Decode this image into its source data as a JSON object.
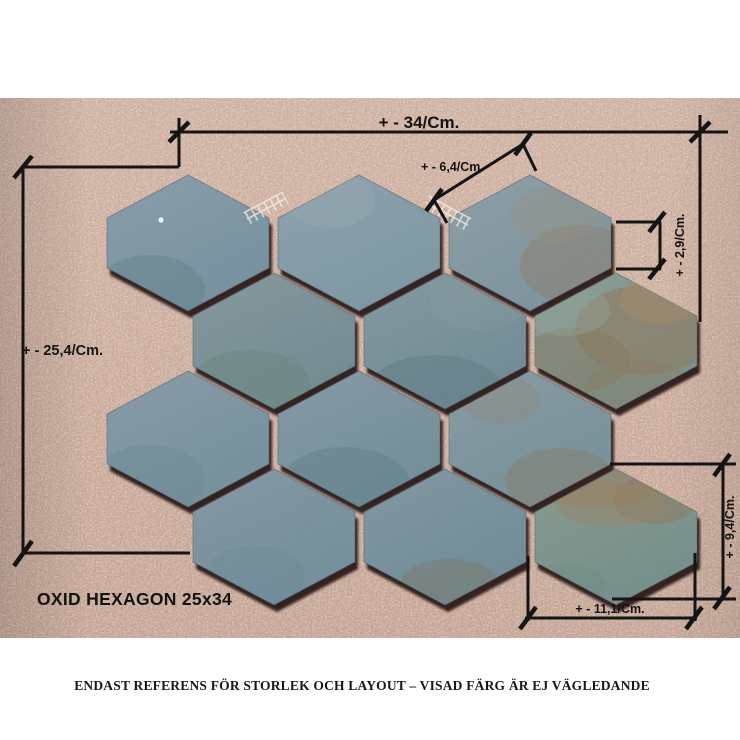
{
  "product_label": "OXID HEXAGON 25x34",
  "caption": "ENDAST REFERENS FÖR STORLEK OCH LAYOUT – VISAD FÄRG ÄR EJ VÄGLEDANDE",
  "measurements": {
    "total_width": "+ - 34/Cm.",
    "total_height": "+ - 25,4/Cm.",
    "hex_edge": "+ - 6,4/Cm",
    "hex_side": "+ - 2,9/Cm.",
    "hex_height": "+ - 9,4/Cm.",
    "hex_width": "+ - 11,1/Cm."
  },
  "colors": {
    "page_bg": "#ffffff",
    "cork_top": "#cdafa0",
    "cork_bottom": "#c2a292",
    "annotation_line": "#141414",
    "grout_shadow": "#1d1309",
    "tile_edge_stroke": "#4f646d"
  },
  "sheet": {
    "hex": {
      "half_width": 81,
      "half_height": 68,
      "half_side": 25
    },
    "rows": 4,
    "tiles_per_row": 3
  },
  "tiles": [
    {
      "id": "r1c1",
      "cx": 188,
      "cy": 243,
      "fill": [
        "#899caa",
        "#75909d"
      ],
      "spots": [
        {
          "x": 150,
          "y": 290,
          "rx": 55,
          "ry": 35,
          "c": "#64808c",
          "o": 0.45
        }
      ]
    },
    {
      "id": "r1c2",
      "cx": 359,
      "cy": 243,
      "fill": [
        "#8da2ae",
        "#7b96a2"
      ],
      "spots": [
        {
          "x": 330,
          "y": 200,
          "rx": 45,
          "ry": 28,
          "c": "#9aa9ae",
          "o": 0.35
        }
      ]
    },
    {
      "id": "r1c3",
      "cx": 530,
      "cy": 243,
      "fill": [
        "#8c9ea6",
        "#7c929c"
      ],
      "spots": [
        {
          "x": 580,
          "y": 265,
          "rx": 60,
          "ry": 40,
          "c": "#8b7f6d",
          "o": 0.5
        },
        {
          "x": 555,
          "y": 215,
          "rx": 45,
          "ry": 28,
          "c": "#959084",
          "o": 0.4
        }
      ]
    },
    {
      "id": "r2c1",
      "cx": 274,
      "cy": 341,
      "fill": [
        "#85979d",
        "#708a90"
      ],
      "spots": [
        {
          "x": 250,
          "y": 385,
          "rx": 60,
          "ry": 35,
          "c": "#6a857d",
          "o": 0.45
        }
      ]
    },
    {
      "id": "r2c2",
      "cx": 445,
      "cy": 341,
      "fill": [
        "#83989f",
        "#6f8a94"
      ],
      "spots": [
        {
          "x": 435,
          "y": 395,
          "rx": 70,
          "ry": 40,
          "c": "#5e7a82",
          "o": 0.45
        },
        {
          "x": 480,
          "y": 300,
          "rx": 50,
          "ry": 30,
          "c": "#8c9ba0",
          "o": 0.3
        }
      ]
    },
    {
      "id": "r2c3",
      "cx": 616,
      "cy": 341,
      "fill": [
        "#8a9b94",
        "#75908c"
      ],
      "spots": [
        {
          "x": 645,
          "y": 330,
          "rx": 70,
          "ry": 45,
          "c": "#93785c",
          "o": 0.55
        },
        {
          "x": 575,
          "y": 360,
          "rx": 55,
          "ry": 32,
          "c": "#857a62",
          "o": 0.5
        },
        {
          "x": 660,
          "y": 300,
          "rx": 40,
          "ry": 24,
          "c": "#a28a68",
          "o": 0.5
        },
        {
          "x": 565,
          "y": 310,
          "rx": 45,
          "ry": 26,
          "c": "#92a295",
          "o": 0.45
        },
        {
          "x": 640,
          "y": 390,
          "rx": 55,
          "ry": 30,
          "c": "#8d7c64",
          "o": 0.4
        }
      ]
    },
    {
      "id": "r3c1",
      "cx": 188,
      "cy": 439,
      "fill": [
        "#879aa6",
        "#73909b"
      ],
      "spots": [
        {
          "x": 150,
          "y": 480,
          "rx": 55,
          "ry": 35,
          "c": "#6b8894",
          "o": 0.4
        }
      ]
    },
    {
      "id": "r3c2",
      "cx": 359,
      "cy": 439,
      "fill": [
        "#8499a4",
        "#708d98"
      ],
      "spots": [
        {
          "x": 345,
          "y": 485,
          "rx": 65,
          "ry": 38,
          "c": "#627f89",
          "o": 0.45
        }
      ]
    },
    {
      "id": "r3c3",
      "cx": 530,
      "cy": 439,
      "fill": [
        "#879aa1",
        "#75909a"
      ],
      "spots": [
        {
          "x": 560,
          "y": 480,
          "rx": 55,
          "ry": 32,
          "c": "#897d69",
          "o": 0.45
        },
        {
          "x": 500,
          "y": 400,
          "rx": 40,
          "ry": 24,
          "c": "#8f887a",
          "o": 0.35
        }
      ]
    },
    {
      "id": "r4c1",
      "cx": 274,
      "cy": 537,
      "fill": [
        "#8497a3",
        "#718e9a"
      ],
      "spots": [
        {
          "x": 255,
          "y": 575,
          "rx": 50,
          "ry": 30,
          "c": "#6d8a96",
          "o": 0.4
        }
      ]
    },
    {
      "id": "r4c2",
      "cx": 445,
      "cy": 537,
      "fill": [
        "#8196a1",
        "#6e8b96"
      ],
      "spots": [
        {
          "x": 450,
          "y": 585,
          "rx": 50,
          "ry": 26,
          "c": "#7d7565",
          "o": 0.4
        }
      ]
    },
    {
      "id": "r4c3",
      "cx": 616,
      "cy": 537,
      "fill": [
        "#87998f",
        "#748e8a"
      ],
      "spots": [
        {
          "x": 600,
          "y": 482,
          "rx": 65,
          "ry": 26,
          "c": "#977c5e",
          "o": 0.55
        },
        {
          "x": 655,
          "y": 500,
          "rx": 42,
          "ry": 24,
          "c": "#8d7a60",
          "o": 0.5
        },
        {
          "x": 610,
          "y": 505,
          "rx": 55,
          "ry": 22,
          "c": "#9a8668",
          "o": 0.45
        },
        {
          "x": 565,
          "y": 585,
          "rx": 40,
          "ry": 22,
          "c": "#6f8b85",
          "o": 0.4
        }
      ]
    }
  ]
}
